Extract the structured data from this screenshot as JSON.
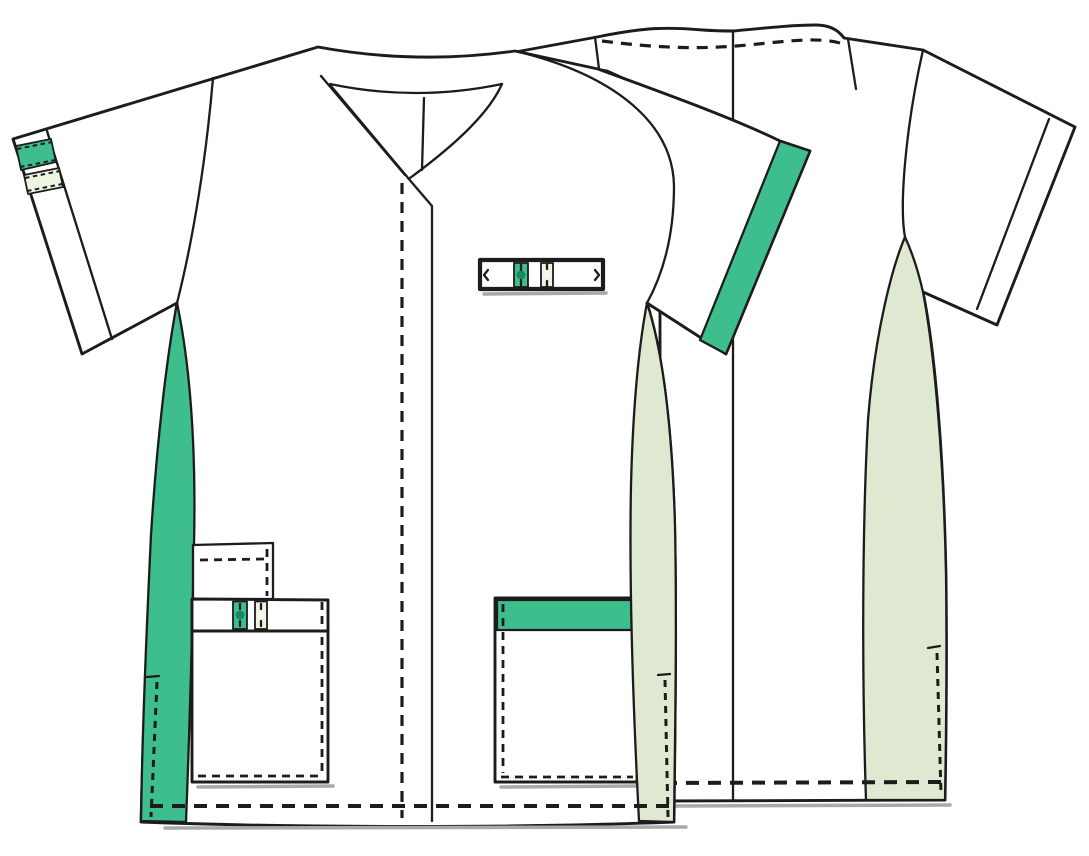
{
  "figure": {
    "type": "garment-technical-flat",
    "subject": "short-sleeve v-neck medical tunic with contrast trim",
    "views": [
      "front",
      "back"
    ]
  },
  "colors": {
    "background": "#ffffff",
    "garment_white": "#ffffff",
    "line": "#1c1c1c",
    "shadow": "#a9a9a9",
    "accent_green": "#3ebe8c",
    "accent_green_dark": "#168a5f",
    "pale_green": "#dfe9d2",
    "pale_stripe": "#eef4e4",
    "pale_dot": "#f4f8ee"
  }
}
